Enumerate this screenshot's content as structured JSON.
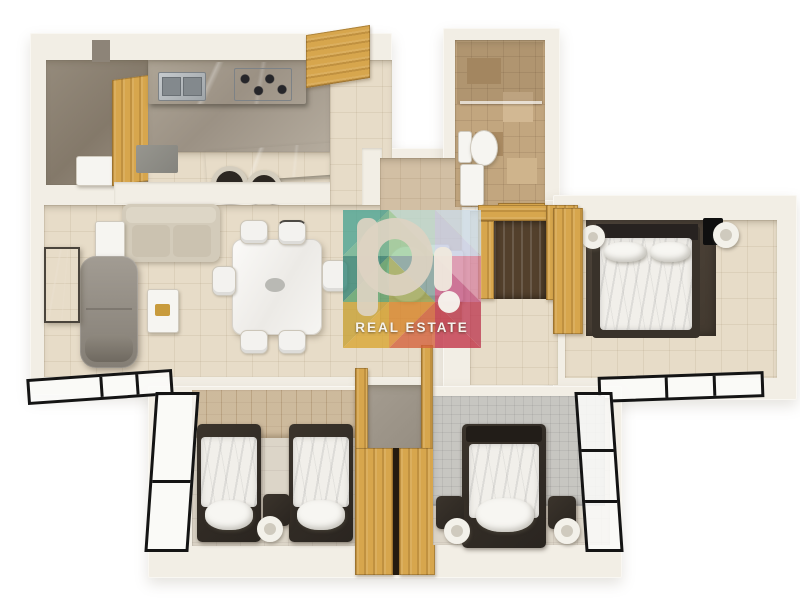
{
  "image": {
    "kind": "3d-floor-plan-top-view",
    "background": "#ffffff"
  },
  "watermark": {
    "logo_text": "p!",
    "label": "REAL ESTATE",
    "logo_color": "#ddd3c2",
    "label_color": "#f5f3ee",
    "tiles": [
      "#4aa392",
      "#67b391",
      "#bfdcd4",
      "#9ccf9f",
      "#ccdce8",
      "#c9cfe6",
      "#2f8273",
      "#5aa26b",
      "#7a9a94",
      "#9aa34f",
      "#d887a3",
      "#c2527e",
      "#c8a032",
      "#d9a530",
      "#dd8a2e",
      "#d4603a",
      "#be3a52",
      "#c23247"
    ]
  },
  "palette": {
    "wall": "#f2eee5",
    "tile": "#e7dcc8",
    "tan": "#c2a67f",
    "tanwall": "#c6b08f",
    "greige": "#dcd5c8",
    "graytile": "#c7c6c1",
    "wood": "#d7a64d",
    "counter": "#2e2d2b",
    "dark": "#332d26",
    "rug": "#4a4137",
    "bedding": "#f1efea",
    "sofa": "#d3cbba",
    "graysofa": "#968f86",
    "frame": "#141414"
  },
  "scene": {
    "rooms": [
      {
        "name": "utility-room",
        "furniture": [
          "washer",
          "wood-panel"
        ]
      },
      {
        "name": "kitchen",
        "furniture": [
          "sink-counter",
          "stove",
          "island",
          "bar-stools"
        ]
      },
      {
        "name": "entry-foyer",
        "furniture": [
          "entry-door"
        ]
      },
      {
        "name": "living-room",
        "furniture": [
          "beige-sofa",
          "gray-chaise",
          "artwork",
          "coffee-table",
          "side-table"
        ]
      },
      {
        "name": "dining-area",
        "furniture": [
          "dining-table",
          "six-chairs"
        ]
      },
      {
        "name": "powder-room",
        "furniture": [
          "toilet",
          "vanity"
        ]
      },
      {
        "name": "main-bathroom",
        "furniture": [
          "shower",
          "glass-screen",
          "toilet",
          "vanity"
        ]
      },
      {
        "name": "hallway",
        "furniture": [
          "walk-in-closet"
        ]
      },
      {
        "name": "master-bedroom",
        "furniture": [
          "double-bed",
          "wall-sconces",
          "tv-console",
          "wardrobe",
          "balcony-windows"
        ]
      },
      {
        "name": "twin-bedroom",
        "furniture": [
          "twin-bed",
          "twin-bed",
          "nightstand",
          "lamp",
          "wardrobes",
          "corner-window"
        ]
      },
      {
        "name": "double-bedroom",
        "furniture": [
          "double-bed",
          "nightstands",
          "lamps",
          "corner-window"
        ]
      }
    ]
  }
}
